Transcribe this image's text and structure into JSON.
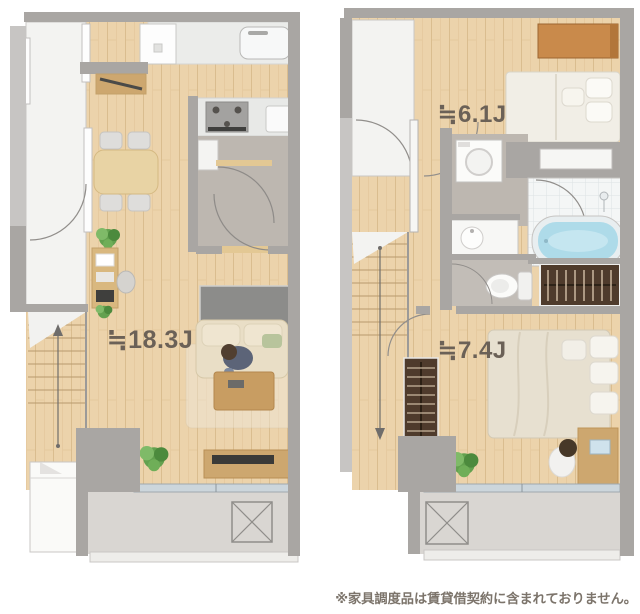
{
  "floorplans": {
    "floor1": {
      "living_dining_label": "≒18.3J"
    },
    "floor2": {
      "bedroom_small_label": "≒6.1J",
      "bedroom_large_label": "≒7.4J"
    }
  },
  "disclaimer": "※家具調度品は賃貸借契約に含まれておりません。",
  "colors": {
    "label_text": "#6b6157",
    "disclaimer_text": "#7c746b",
    "wall": "#a9a6a3",
    "wall_light": "#c7c5c3",
    "wood_floor": "#ecd3ab",
    "wood_plank_line": "#d5b585",
    "hall_floor": "#bdb7b0",
    "toilet_floor": "#c2bdb7",
    "balcony_floor": "#d9d6d2",
    "tile_floor": "#f4f6f6",
    "bathtub": "#aedbe9",
    "window_glass": "#ccd6dc",
    "counter_white": "#ebecea",
    "corridor_white": "#f3f3f1",
    "stove_gray": "#a3a2a0",
    "void_gray": "#8c8c8a",
    "wardrobe_wood": "#c98a4b",
    "closet_dark": "#4f3b2c",
    "furniture_wood": "#cda76f",
    "sofa_beige": "#e9dec6",
    "bed_white": "#f1eee6",
    "bed_beige": "#e7e0d0",
    "plant_green": "#63a14f"
  }
}
